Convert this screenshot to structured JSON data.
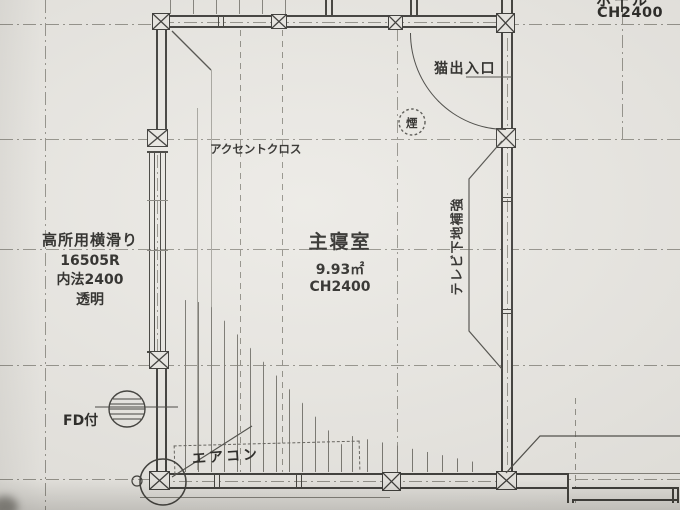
{
  "page": {
    "type": "architectural-floor-plan-photo",
    "paper_color": "#eae8e3",
    "line_color": "#35342f",
    "grid_color": "#8e8c84"
  },
  "hall": {
    "name": "ホール",
    "ceiling_height": "CH2400"
  },
  "room": {
    "name": "主寝室",
    "area": "9.93㎡",
    "ceiling_height": "CH2400"
  },
  "window_left": {
    "type": "高所用横滑り",
    "code": "16505R",
    "inner_dimension": "内法2400",
    "glass": "透明"
  },
  "annotations": {
    "cat_door": "猫出入口",
    "smoke_detector": "煙",
    "accent_cloth": "アクセントクロス",
    "tv_backing": "テレビ下地補強",
    "aircon": "エアコン",
    "fire_damper": "FD付"
  }
}
